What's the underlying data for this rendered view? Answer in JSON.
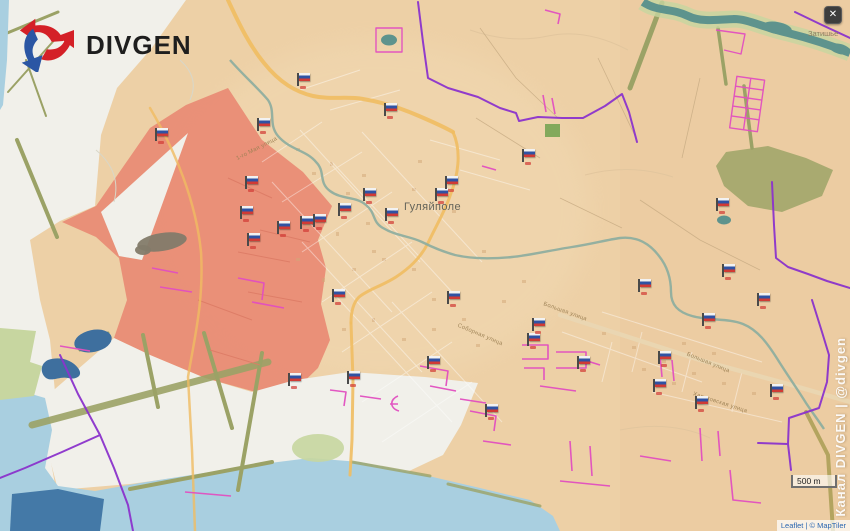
{
  "brand": {
    "name": "DIVGEN"
  },
  "ui": {
    "close_button": "✕",
    "scale_bar": "500 m",
    "attribution": "Leaflet | © MapTiler",
    "watermark": "Канал DIVGEN | @divgen"
  },
  "labels": {
    "town": "Гуляйполе",
    "village": "Затишье"
  },
  "street_labels": [
    {
      "text": "1-го Мая улица",
      "x": 257,
      "y": 149,
      "rot": -27
    },
    {
      "text": "Соборная улица",
      "x": 480,
      "y": 335,
      "rot": 23
    },
    {
      "text": "Большая улица",
      "x": 565,
      "y": 312,
      "rot": 20
    },
    {
      "text": "Большая улица",
      "x": 708,
      "y": 363,
      "rot": 22
    },
    {
      "text": "Харьковская улица",
      "x": 720,
      "y": 403,
      "rot": 18
    }
  ],
  "flags": [
    [
      155,
      127
    ],
    [
      245,
      175
    ],
    [
      257,
      117
    ],
    [
      277,
      220
    ],
    [
      297,
      72
    ],
    [
      300,
      215
    ],
    [
      313,
      213
    ],
    [
      338,
      202
    ],
    [
      363,
      187
    ],
    [
      384,
      102
    ],
    [
      385,
      207
    ],
    [
      427,
      355
    ],
    [
      435,
      187
    ],
    [
      445,
      175
    ],
    [
      447,
      290
    ],
    [
      485,
      403
    ],
    [
      522,
      148
    ],
    [
      527,
      332
    ],
    [
      532,
      317
    ],
    [
      577,
      355
    ],
    [
      638,
      278
    ],
    [
      653,
      378
    ],
    [
      658,
      350
    ],
    [
      695,
      395
    ],
    [
      702,
      312
    ],
    [
      716,
      197
    ],
    [
      722,
      263
    ],
    [
      757,
      292
    ],
    [
      770,
      383
    ],
    [
      332,
      288
    ],
    [
      347,
      370
    ],
    [
      240,
      205
    ],
    [
      247,
      232
    ],
    [
      288,
      372
    ]
  ],
  "colors": {
    "tan": "#edd0a6",
    "red": "#e98c75",
    "field": "#f1f0ea",
    "water": "#a9cfe0",
    "pond": "#3e6f9e",
    "pond_dark": "#4479a7",
    "river": "#8fae9f",
    "teal": "#5e938d",
    "green": "#c7d6a0",
    "olive": "#9ba266",
    "forest": "#a9aa70",
    "road": "#f0bc62",
    "purple": "#8b33cc",
    "pink": "#e24fc0",
    "flag_white": "#f2f2f2",
    "flag_blue": "#2f52a3",
    "flag_red": "#d13a34",
    "logo_red": "#d42027",
    "logo_blue": "#2b56a4"
  }
}
